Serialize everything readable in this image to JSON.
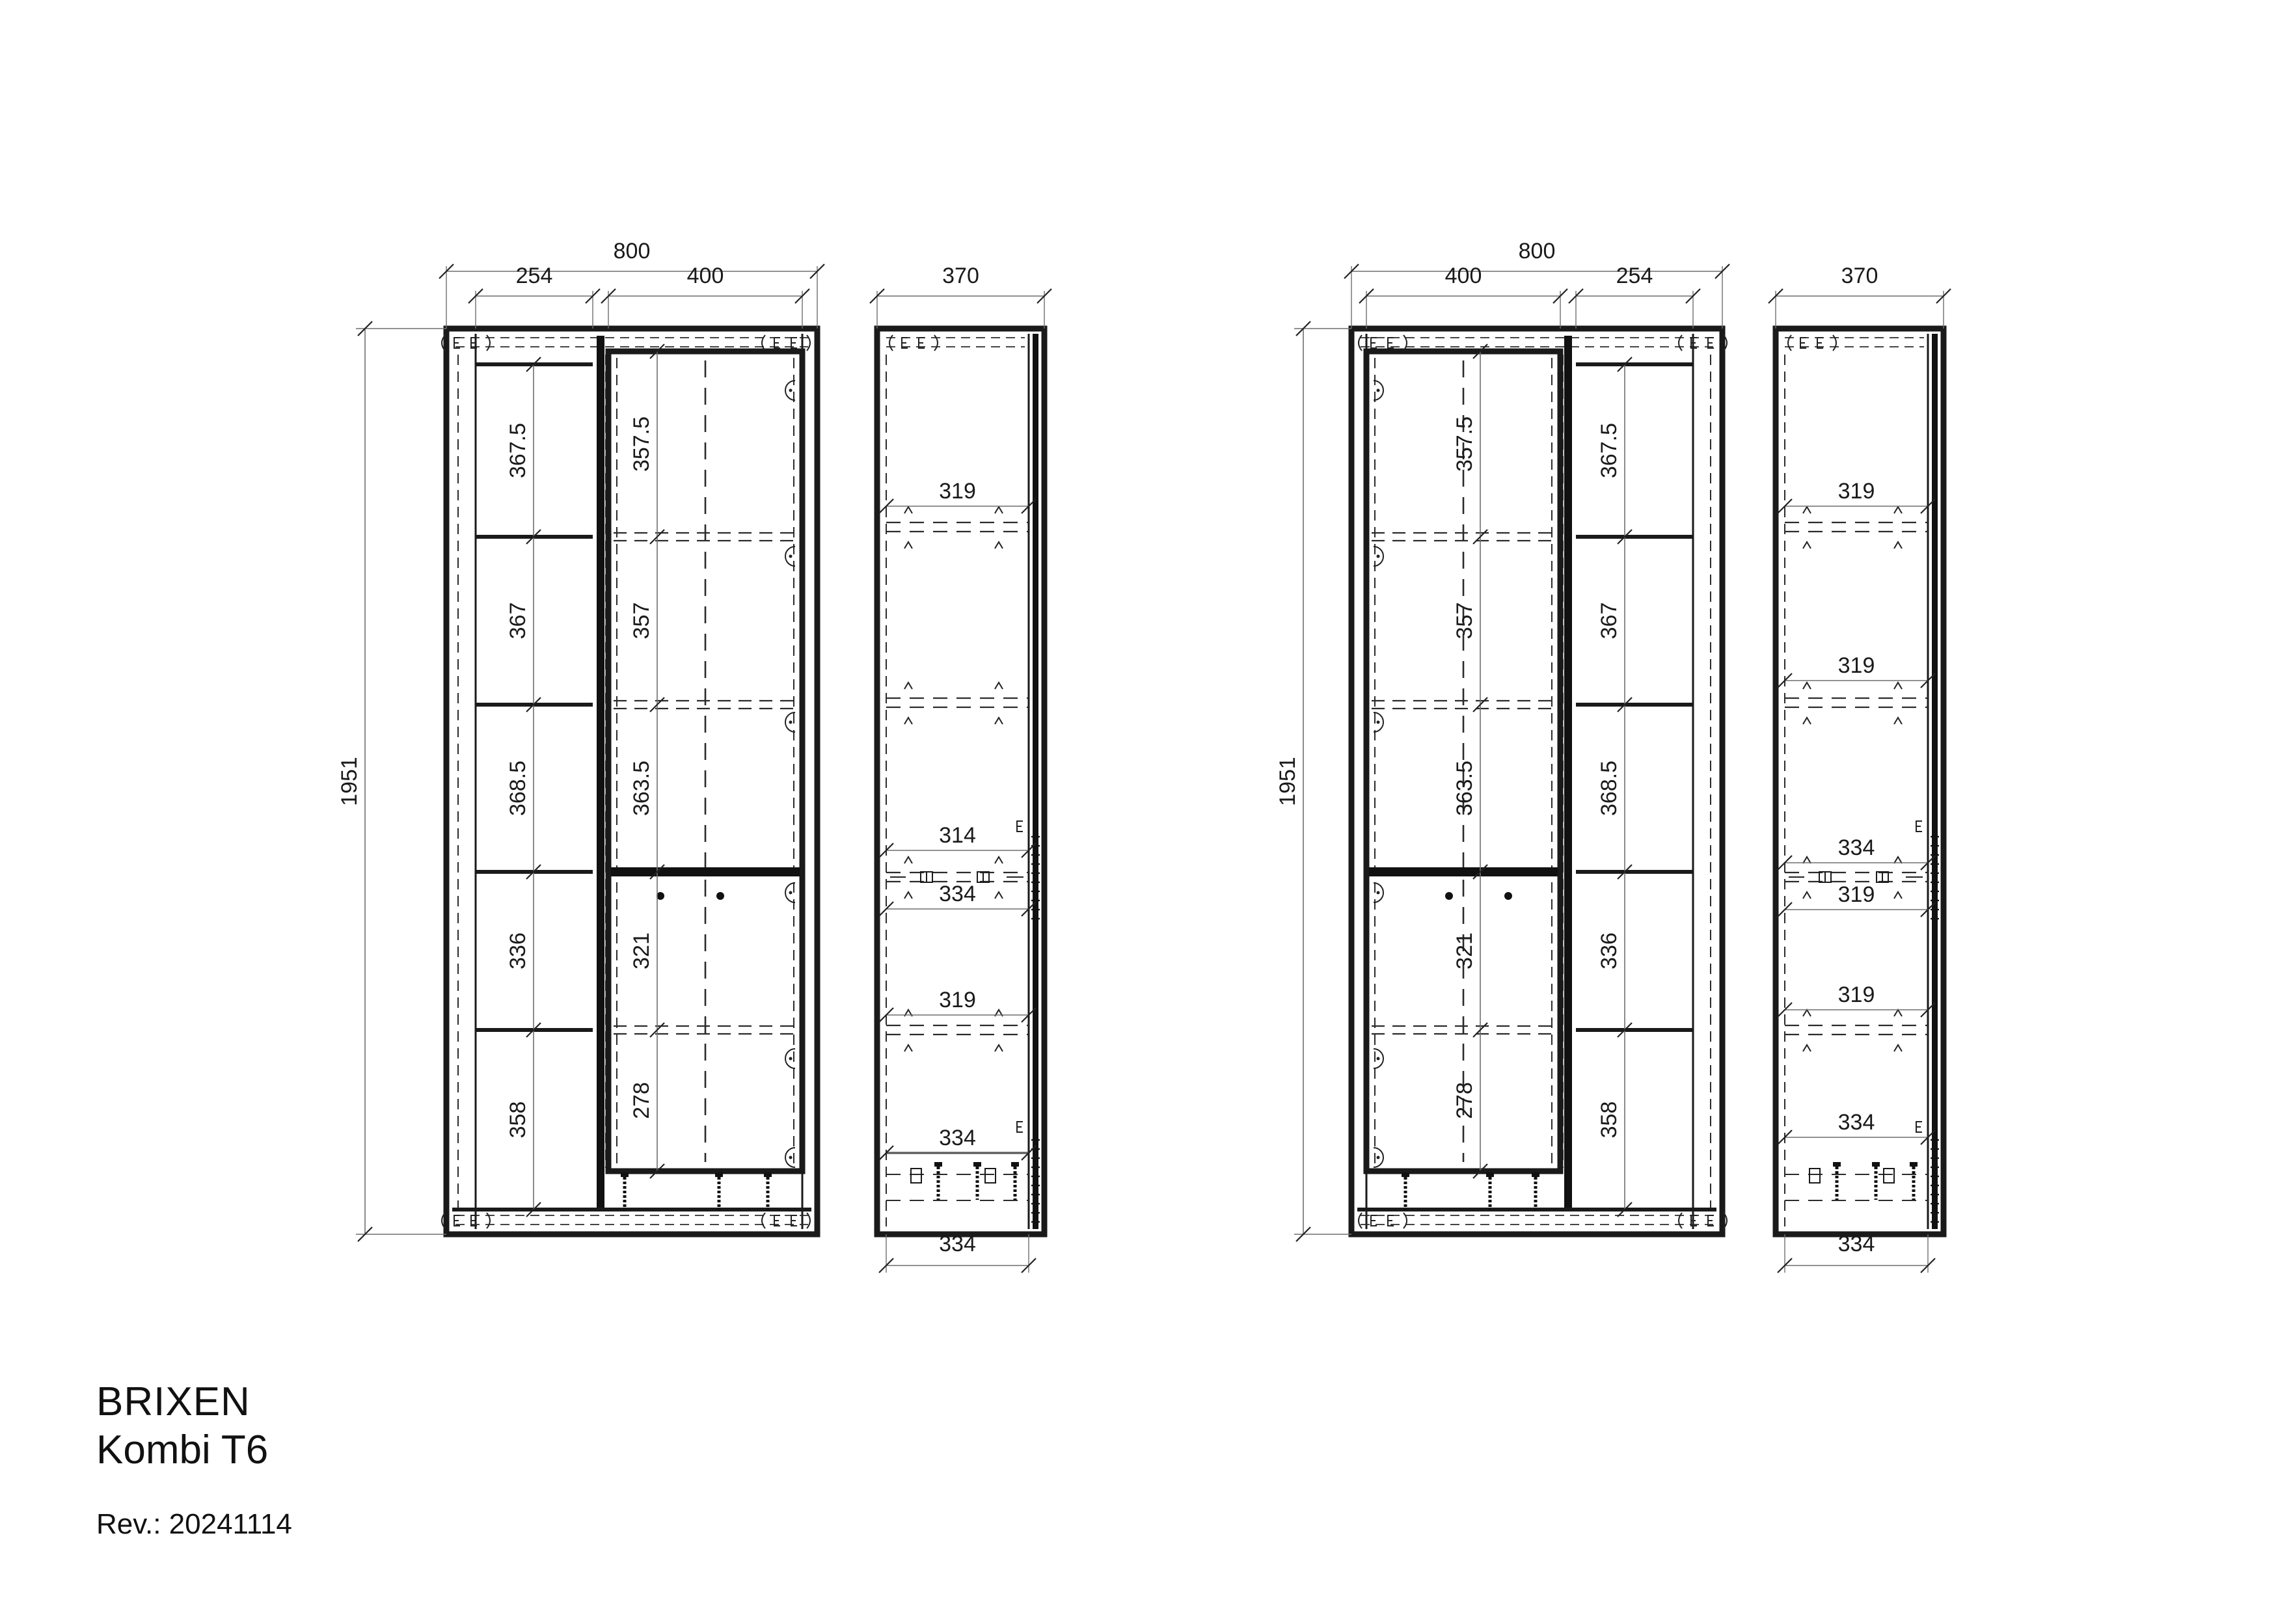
{
  "meta": {
    "product": "BRIXEN",
    "variant": "Kombi T6",
    "revision": "Rev.: 20241114"
  },
  "colors": {
    "line": "#1a1a1a",
    "hidden_line": "#2b2b2b",
    "dim_line": "#6f6f6f",
    "text": "#1a1a1a",
    "background": "#ffffff"
  },
  "views": {
    "front_left": {
      "label": "front-view-left",
      "total_width": "800",
      "narrow_col_width": "254",
      "door_col_width": "400",
      "height": "1951",
      "narrow_sections": [
        "367.5",
        "367",
        "368.5",
        "336",
        "358"
      ],
      "door_sections": [
        "357.5",
        "357",
        "363.5",
        "321",
        "278"
      ]
    },
    "side_left": {
      "label": "side-view-left",
      "depth": "370",
      "bottom_depth": "334",
      "sections": [
        "319",
        "314",
        "334",
        "319",
        "334"
      ]
    },
    "front_right": {
      "label": "front-view-right",
      "total_width": "800",
      "narrow_col_width": "254",
      "door_col_width": "400",
      "height": "1951",
      "narrow_sections": [
        "367.5",
        "367",
        "368.5",
        "336",
        "358"
      ],
      "door_sections": [
        "357.5",
        "357",
        "363.5",
        "321",
        "278"
      ]
    },
    "side_right": {
      "label": "side-view-right",
      "depth": "370",
      "bottom_depth": "334",
      "sections": [
        "319",
        "319",
        "334",
        "319",
        "319",
        "334"
      ]
    }
  }
}
